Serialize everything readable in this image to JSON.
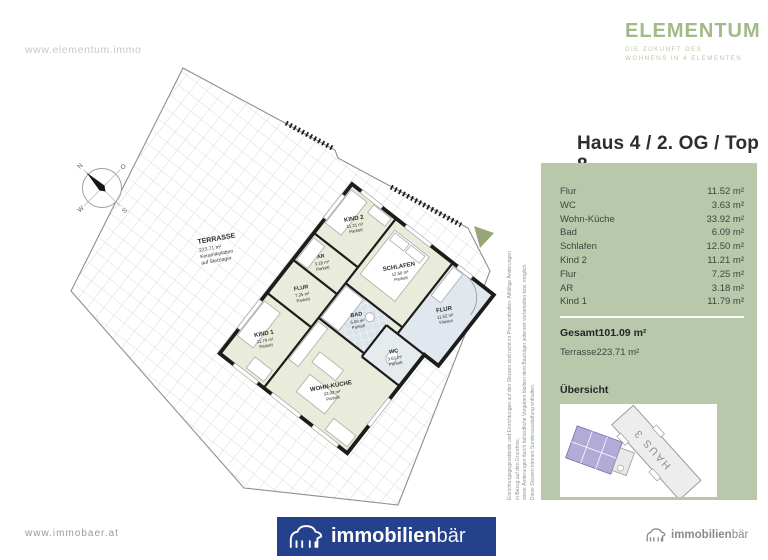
{
  "header": {
    "website": "www.elementum.immo",
    "brand_name": "ELEMENTUM",
    "brand_tagline_line1": "DIE ZUKUNFT DES",
    "brand_tagline_line2": "WOHNENS IN 4 ELEMENTEN",
    "brand_color": "#a3b987"
  },
  "unit_panel": {
    "title": "Haus 4 / 2. OG / Top 8",
    "panel_color": "#b9c7ab",
    "rows": [
      {
        "label": "Flur",
        "value": "11.52 m²"
      },
      {
        "label": "WC",
        "value": "3.63 m²"
      },
      {
        "label": "Wohn-Küche",
        "value": "33.92 m²"
      },
      {
        "label": "Bad",
        "value": "6.09 m²"
      },
      {
        "label": "Schlafen",
        "value": "12.50 m²"
      },
      {
        "label": "Kind 2",
        "value": "11.21 m²"
      },
      {
        "label": "Flur",
        "value": "7.25 m²"
      },
      {
        "label": "AR",
        "value": "3.18 m²"
      },
      {
        "label": "Kind 1",
        "value": "11.79 m²"
      }
    ],
    "total": {
      "label": "Gesamt",
      "value": "101.09 m²"
    },
    "terrace": {
      "label": "Terrasse",
      "value": "223.71 m²"
    },
    "overview": {
      "label": "Übersicht",
      "building_label": "HAUS 3",
      "highlight_color": "#b3aad7"
    }
  },
  "floorplan": {
    "terrace_label": {
      "name": "TERRASSE",
      "area": "223.71 m²",
      "finish1": "Keramikplatten",
      "finish2": "auf Stelzlager"
    },
    "compass": {
      "n": "N",
      "o": "O",
      "s": "S",
      "w": "W"
    },
    "rooms": [
      {
        "name": "KIND 2",
        "area": "11.21 m²",
        "floor": "Parkett"
      },
      {
        "name": "SCHLAFEN",
        "area": "12.50 m²",
        "floor": "Parkett"
      },
      {
        "name": "FLUR",
        "area": "11.52 m²",
        "floor": "Fliesen"
      },
      {
        "name": "AR",
        "area": "3.18 m²",
        "floor": "Parkett"
      },
      {
        "name": "BAD",
        "area": "6.09 m²",
        "floor": "Parkett"
      },
      {
        "name": "WC",
        "area": "3.63 m²",
        "floor": "Parkett"
      },
      {
        "name": "FLUR",
        "area": "7.25 m²",
        "floor": "Parkett"
      },
      {
        "name": "KIND 1",
        "area": "11.79 m²",
        "floor": "Parkett"
      },
      {
        "name": "WOHN-KÜCHE",
        "area": "33.92 m²",
        "floor": "Parkett"
      }
    ]
  },
  "disclaimer": {
    "line1": "Einrichtungsgegenstände und Einrichtungen auf den Skizzen sind nicht im Preis enthalten. Allfällige Änderungen in Bezug auf den Grundriss,",
    "line2": "sowie Änderungen durch behördliche Vorgaben bleiben dem Bauträger jederzeit vorbehalten bzw. möglich.",
    "line3": "Diese Skizzen können Sonderausstattung enthalten."
  },
  "footer": {
    "website": "www.immobaer.at",
    "logo_bold": "immobilien",
    "logo_light": "bär",
    "logo_bg": "#24418c",
    "small_logo_bold": "immobilien",
    "small_logo_light": "bär"
  }
}
